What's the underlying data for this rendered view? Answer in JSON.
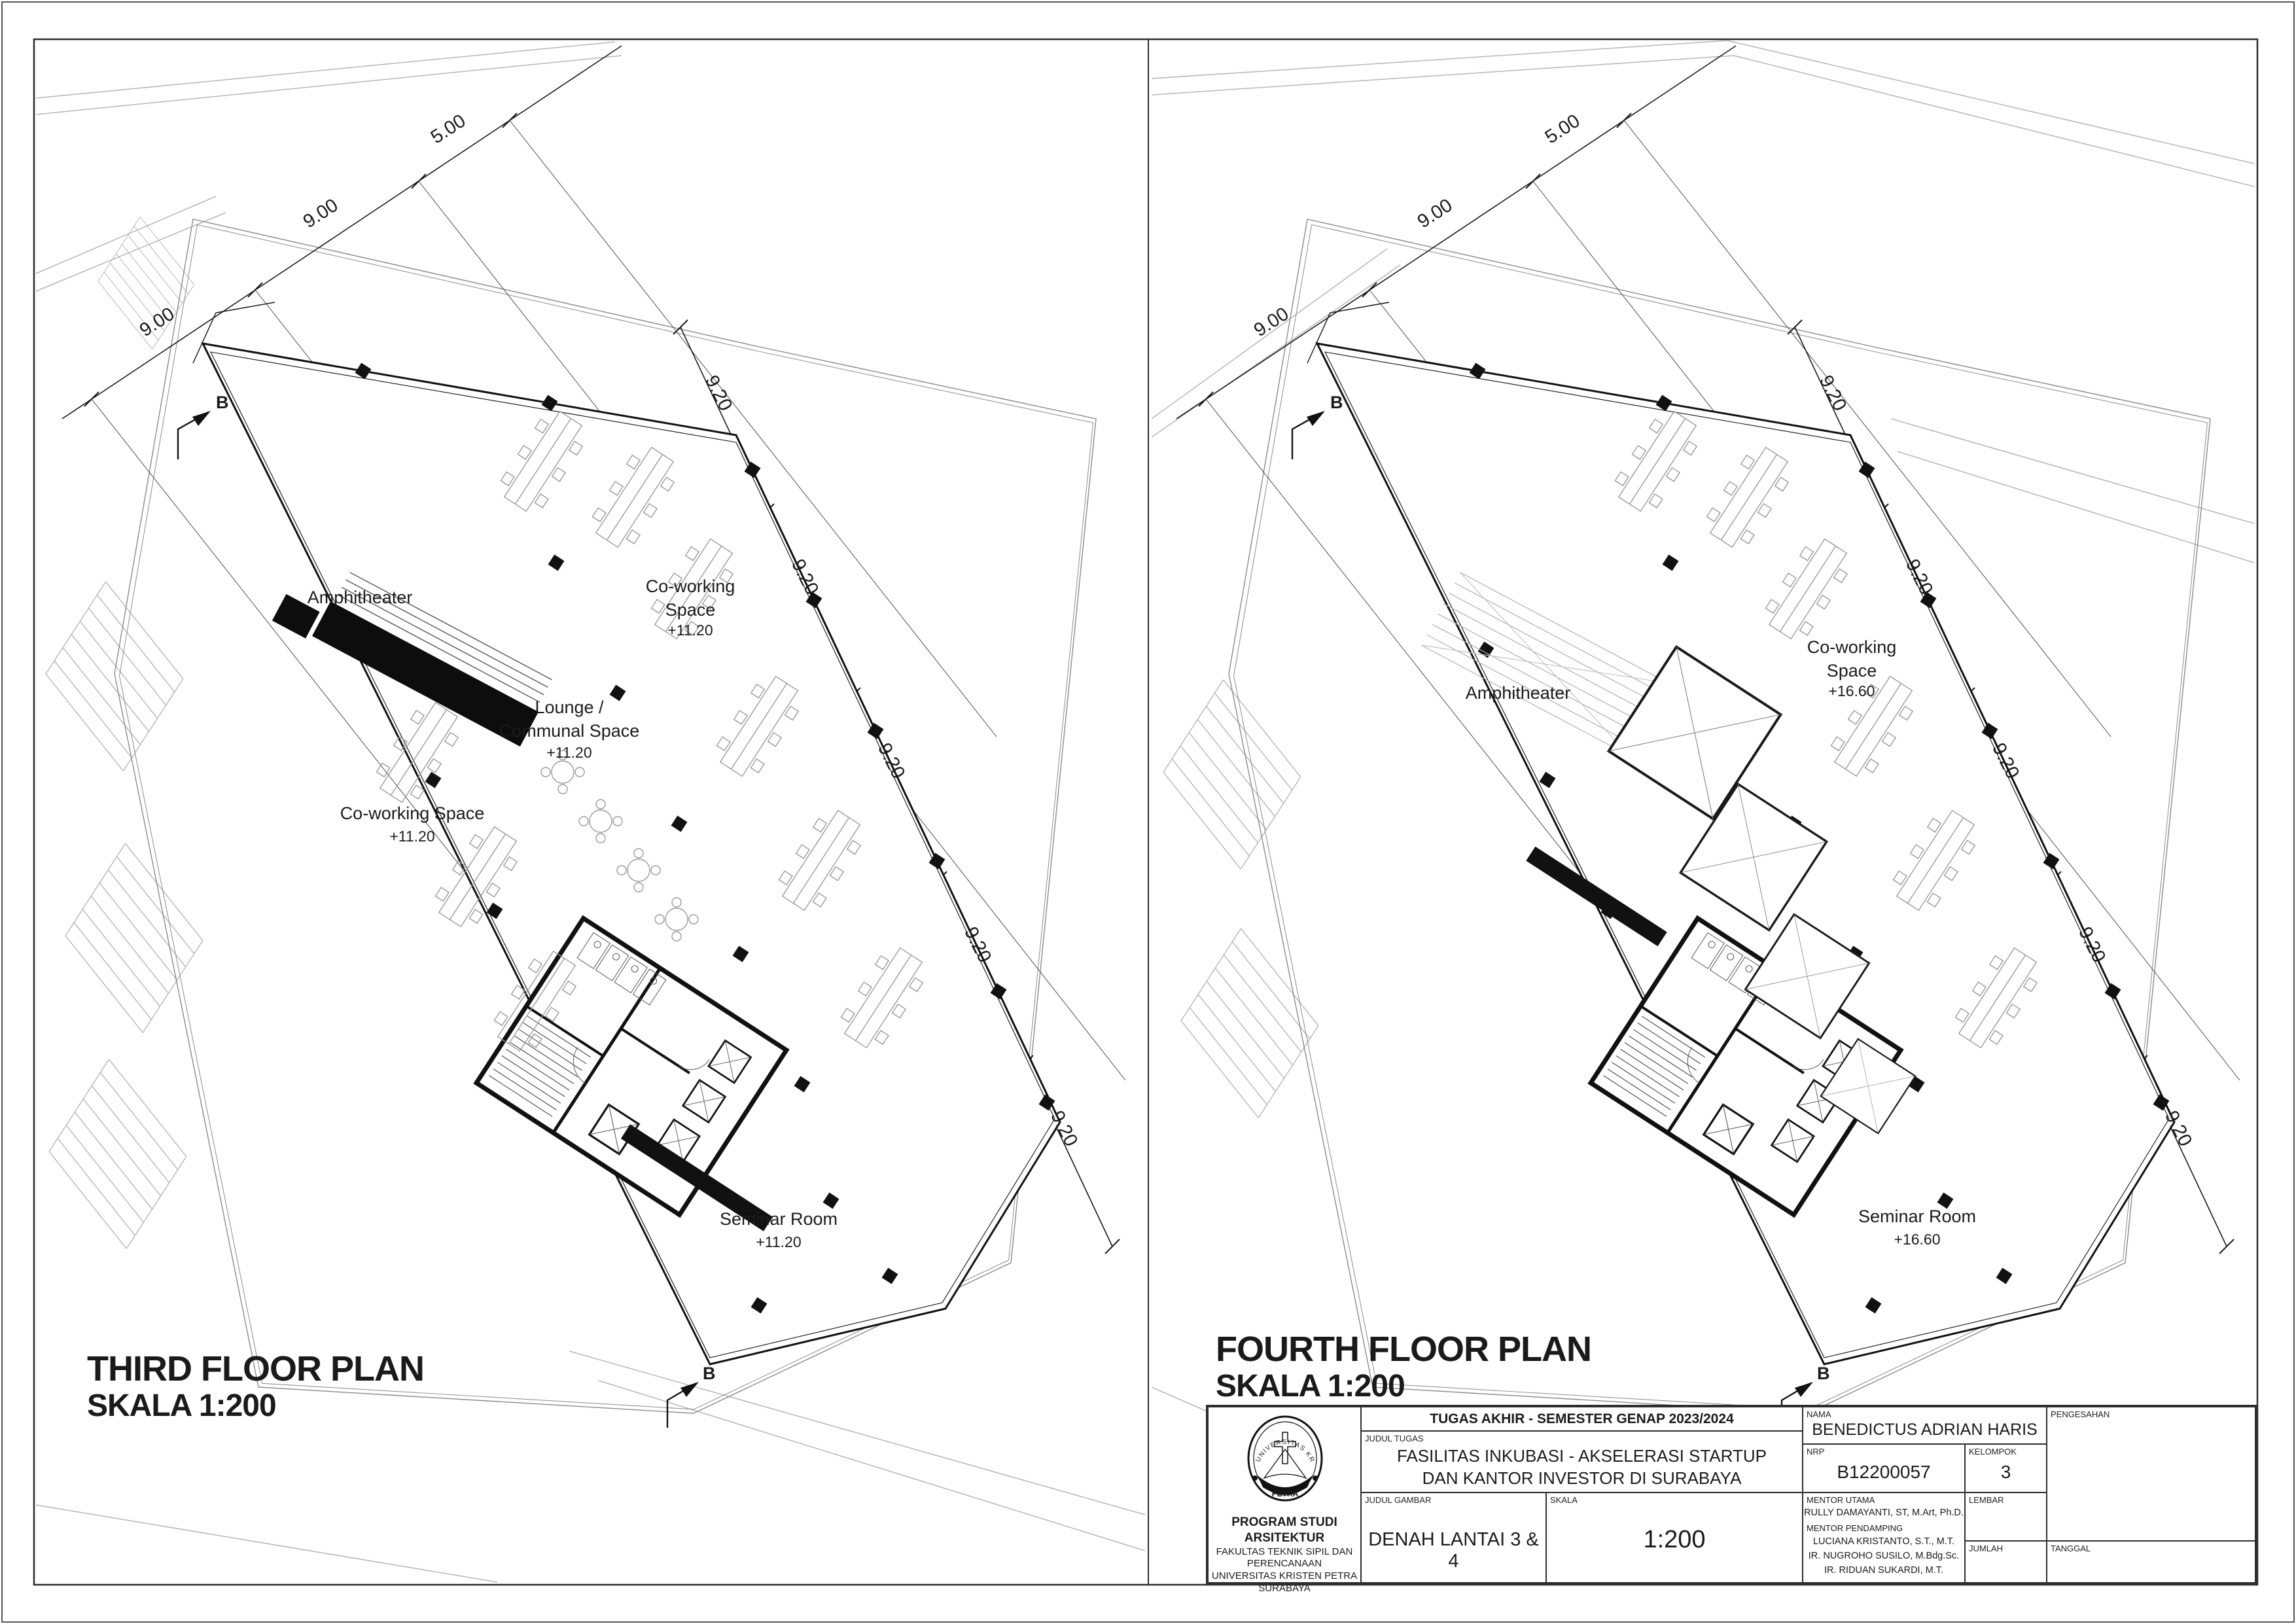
{
  "plans": {
    "third": {
      "title": "THIRD FLOOR PLAN",
      "scale": "SKALA 1:200",
      "amphitheater": "Amphitheater",
      "lounge1": "Lounge /",
      "lounge2": "Communal Space",
      "lounge_level": "+11.20",
      "coworking1": "Co-working",
      "coworking2": "Space",
      "coworking_level": "+11.20",
      "coworking_left": "Co-working Space",
      "coworking_left_level": "+11.20",
      "seminar": "Seminar Room",
      "seminar_level": "+11.20"
    },
    "fourth": {
      "title": "FOURTH FLOOR PLAN",
      "scale": "SKALA 1:200",
      "amphitheater": "Amphitheater",
      "coworking1": "Co-working",
      "coworking2": "Space",
      "coworking_level": "+16.60",
      "seminar": "Seminar Room",
      "seminar_level": "+16.60"
    }
  },
  "dimensions": {
    "top": [
      "9.00",
      "9.00",
      "5.00"
    ],
    "side": [
      "9.20",
      "9.20",
      "9.20",
      "9.20",
      "9.20"
    ],
    "section_marker": "B"
  },
  "title_block": {
    "header": "TUGAS AKHIR - SEMESTER GENAP 2023/2024",
    "labels": {
      "judul_tugas": "JUDUL TUGAS",
      "judul_gambar": "JUDUL GAMBAR",
      "skala": "SKALA",
      "nama": "NAMA",
      "nrp": "NRP",
      "kelompok": "KELOMPOK",
      "mentor_utama": "MENTOR UTAMA",
      "mentor_pendamping": "MENTOR PENDAMPING",
      "lembar": "LEMBAR",
      "jumlah": "JUMLAH",
      "tanggal": "TANGGAL",
      "pengesahan": "PENGESAHAN"
    },
    "judul_tugas_line1": "FASILITAS INKUBASI - AKSELERASI STARTUP",
    "judul_tugas_line2": "DAN KANTOR INVESTOR DI SURABAYA",
    "judul_gambar_value": "DENAH LANTAI 3 & 4",
    "skala_value": "1:200",
    "nama_value": "BENEDICTUS ADRIAN HARIS",
    "nrp_value": "B12200057",
    "kelompok_value": "3",
    "mentor_utama_value": "RULLY DAMAYANTI, ST, M.Art, Ph.D.",
    "mentor_pendamping_values": [
      "LUCIANA KRISTANTO, S.T., M.T.",
      "IR. NUGROHO SUSILO, M.Bdg.Sc.",
      "IR. RIDUAN SUKARDI, M.T."
    ],
    "institution": {
      "line1": "PROGRAM STUDI ARSITEKTUR",
      "line2": "FAKULTAS TEKNIK SIPIL DAN PERENCANAAN",
      "line3": "UNIVERSITAS KRISTEN PETRA",
      "line4": "SURABAYA"
    },
    "logo": {
      "top_text": "UNIVERSITAS KRISTEN",
      "bottom_text": "PETRA"
    }
  }
}
